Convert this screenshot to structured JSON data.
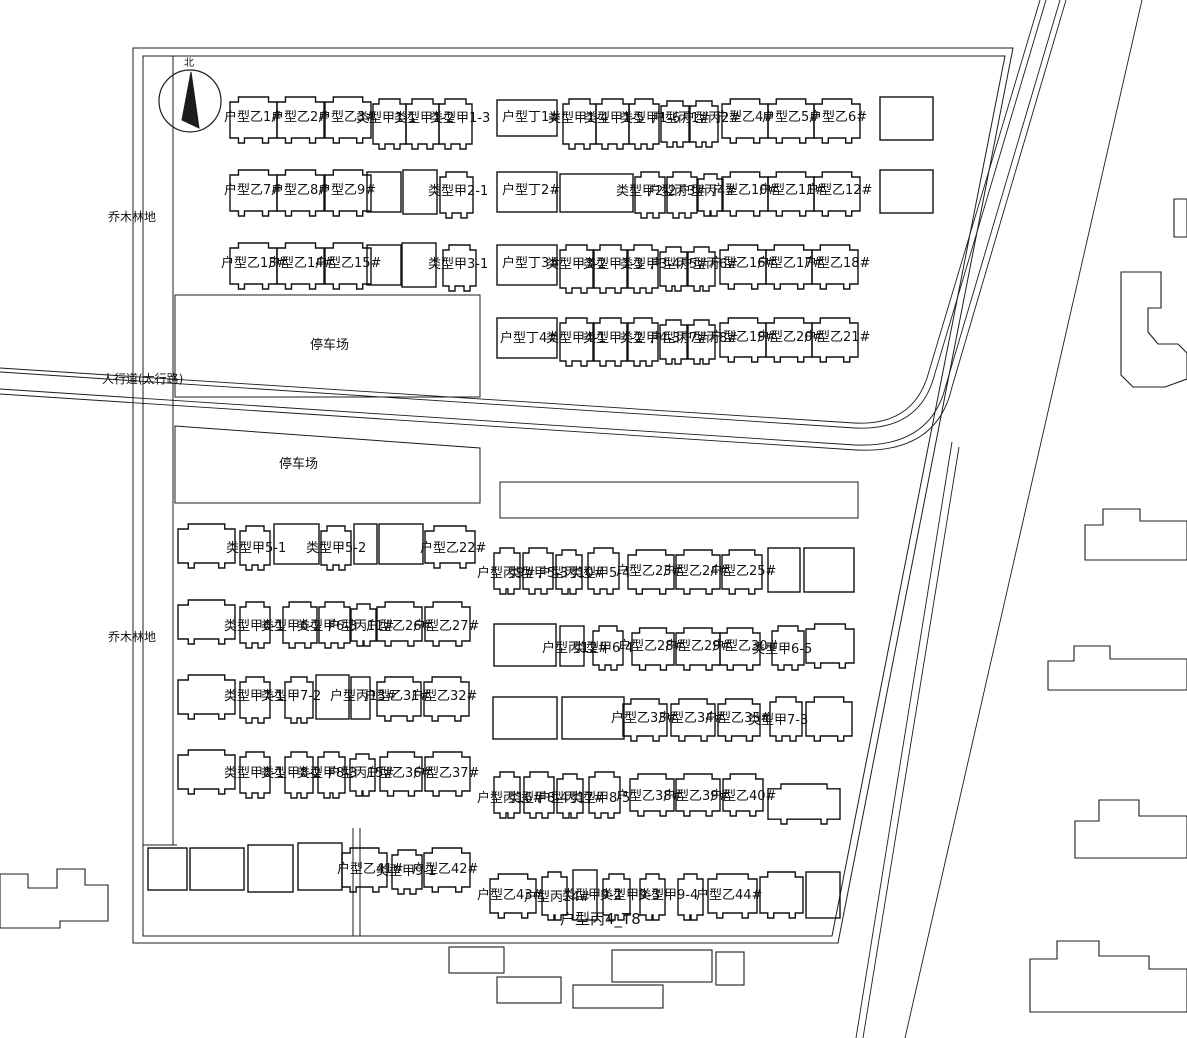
{
  "meta": {
    "width": 1187,
    "height": 1038
  },
  "colors": {
    "bg": "#ffffff",
    "line": "#1c1c1c",
    "building": "#111111",
    "text": "#111111"
  },
  "drawing": {
    "boundary": [
      "M133,48 L1013,48 L838,943 L133,943 Z",
      "M143,56 L1005,56 L832,936 L143,936 Z"
    ],
    "aux_lines": [
      "M173,56 L173,845",
      "M143,845 L177,845",
      "M353,828 L353,936",
      "M360,828 L360,936"
    ],
    "roads": [
      "M1040,0 L927,378 Q911,426 854,423 L0,368",
      "M1046,0 L933,380 Q917,431 855,428 L0,372",
      "M1060,0 L946,385 Q931,448 855,445 L0,389",
      "M1066,0 L952,387 Q937,454 856,450 L0,394",
      "M1142,0 L905,1038",
      "M952,442 L856,1038",
      "M959,447 L863,1038"
    ],
    "parking_areas": [
      "175,295 480,295 480,397 175,397",
      "175,426 480,448 480,503 175,503",
      "500,482 858,482 858,518 500,518"
    ],
    "outside_buildings": [
      "0,874 28,874 28,888 57,888 57,869 85,869 85,885 108,885 108,921 60,921 60,928 0,928",
      "1174,199 1187,199 1187,237 1174,237",
      "1121,272 1161,272 1161,308 1148,308 1148,332 1158,344 1178,344 1187,353 1187,379 1165,387 1133,387 1121,375",
      "1085,525 1103,525 1103,509 1140,509 1140,521 1187,521 1187,560 1085,560",
      "1048,661 1074,661 1074,646 1110,646 1110,659 1187,659 1187,690 1048,690",
      "1075,821 1099,821 1099,800 1139,800 1139,816 1187,816 1187,858 1075,858",
      "1030,959 1057,959 1057,941 1099,941 1099,956 1149,956 1149,969 1187,969 1187,1012 1030,1012"
    ],
    "neighbor_rects": [
      [
        449,
        947,
        55,
        26
      ],
      [
        497,
        977,
        64,
        26
      ],
      [
        612,
        950,
        100,
        32
      ],
      [
        573,
        985,
        90,
        23
      ],
      [
        716,
        952,
        28,
        33
      ]
    ],
    "buildings": [
      [
        230,
        97,
        47,
        46,
        "n"
      ],
      [
        277,
        97,
        47,
        46,
        "n"
      ],
      [
        325,
        97,
        46,
        46,
        "n"
      ],
      [
        373,
        99,
        33,
        50,
        "n"
      ],
      [
        406,
        99,
        33,
        50,
        "n"
      ],
      [
        439,
        99,
        33,
        50,
        "n"
      ],
      [
        497,
        100,
        60,
        36,
        "r"
      ],
      [
        563,
        99,
        33,
        50,
        "n"
      ],
      [
        596,
        99,
        33,
        50,
        "n"
      ],
      [
        629,
        99,
        30,
        50,
        "n"
      ],
      [
        661,
        101,
        28,
        46,
        "n"
      ],
      [
        690,
        101,
        28,
        46,
        "n"
      ],
      [
        722,
        99,
        46,
        44,
        "n"
      ],
      [
        768,
        99,
        46,
        44,
        "n"
      ],
      [
        814,
        99,
        46,
        44,
        "n"
      ],
      [
        880,
        97,
        53,
        43,
        "r"
      ],
      [
        230,
        170,
        47,
        46,
        "n"
      ],
      [
        277,
        170,
        47,
        46,
        "n"
      ],
      [
        325,
        170,
        46,
        46,
        "n"
      ],
      [
        367,
        172,
        34,
        40,
        "r"
      ],
      [
        403,
        170,
        34,
        44,
        "r"
      ],
      [
        440,
        172,
        33,
        46,
        "n"
      ],
      [
        497,
        172,
        60,
        40,
        "r"
      ],
      [
        560,
        174,
        73,
        38,
        "r"
      ],
      [
        635,
        172,
        30,
        46,
        "n"
      ],
      [
        667,
        172,
        30,
        46,
        "n"
      ],
      [
        698,
        174,
        25,
        42,
        "n"
      ],
      [
        722,
        172,
        46,
        44,
        "n"
      ],
      [
        768,
        172,
        46,
        44,
        "n"
      ],
      [
        814,
        172,
        46,
        44,
        "n"
      ],
      [
        880,
        170,
        53,
        43,
        "r"
      ],
      [
        230,
        243,
        47,
        46,
        "n"
      ],
      [
        277,
        243,
        47,
        46,
        "n"
      ],
      [
        325,
        243,
        46,
        46,
        "n"
      ],
      [
        367,
        245,
        34,
        40,
        "r"
      ],
      [
        402,
        243,
        34,
        44,
        "r"
      ],
      [
        443,
        245,
        33,
        46,
        "n"
      ],
      [
        497,
        245,
        60,
        40,
        "r"
      ],
      [
        560,
        245,
        33,
        48,
        "n"
      ],
      [
        594,
        245,
        33,
        48,
        "n"
      ],
      [
        628,
        245,
        30,
        48,
        "n"
      ],
      [
        660,
        247,
        27,
        44,
        "n"
      ],
      [
        688,
        247,
        27,
        44,
        "n"
      ],
      [
        720,
        245,
        46,
        44,
        "n"
      ],
      [
        766,
        245,
        46,
        44,
        "n"
      ],
      [
        812,
        245,
        46,
        44,
        "n"
      ],
      [
        497,
        318,
        60,
        40,
        "r"
      ],
      [
        560,
        318,
        33,
        48,
        "n"
      ],
      [
        594,
        318,
        33,
        48,
        "n"
      ],
      [
        628,
        318,
        30,
        48,
        "n"
      ],
      [
        660,
        320,
        27,
        44,
        "n"
      ],
      [
        688,
        320,
        27,
        44,
        "n"
      ],
      [
        720,
        318,
        46,
        44,
        "n"
      ],
      [
        766,
        318,
        46,
        44,
        "n"
      ],
      [
        812,
        318,
        46,
        44,
        "n"
      ],
      [
        178,
        524,
        57,
        44,
        "n"
      ],
      [
        240,
        526,
        30,
        44,
        "n"
      ],
      [
        274,
        524,
        45,
        40,
        "r"
      ],
      [
        321,
        526,
        30,
        44,
        "n"
      ],
      [
        354,
        524,
        23,
        40,
        "r"
      ],
      [
        379,
        524,
        44,
        40,
        "r"
      ],
      [
        425,
        526,
        50,
        42,
        "n"
      ],
      [
        494,
        548,
        26,
        46,
        "n"
      ],
      [
        523,
        548,
        30,
        46,
        "n"
      ],
      [
        556,
        550,
        26,
        44,
        "n"
      ],
      [
        588,
        548,
        31,
        46,
        "n"
      ],
      [
        628,
        550,
        46,
        44,
        "n"
      ],
      [
        676,
        550,
        44,
        44,
        "n"
      ],
      [
        722,
        550,
        40,
        44,
        "n"
      ],
      [
        768,
        548,
        32,
        44,
        "r"
      ],
      [
        804,
        548,
        50,
        44,
        "r"
      ],
      [
        178,
        600,
        57,
        44,
        "n"
      ],
      [
        240,
        602,
        30,
        46,
        "n"
      ],
      [
        283,
        602,
        34,
        46,
        "n"
      ],
      [
        319,
        602,
        31,
        46,
        "n"
      ],
      [
        351,
        604,
        25,
        42,
        "n"
      ],
      [
        377,
        602,
        45,
        44,
        "n"
      ],
      [
        425,
        602,
        45,
        44,
        "n"
      ],
      [
        494,
        624,
        62,
        42,
        "r"
      ],
      [
        560,
        626,
        24,
        40,
        "r"
      ],
      [
        593,
        626,
        30,
        44,
        "n"
      ],
      [
        632,
        628,
        42,
        42,
        "n"
      ],
      [
        676,
        628,
        44,
        42,
        "n"
      ],
      [
        720,
        628,
        40,
        42,
        "n"
      ],
      [
        772,
        626,
        32,
        44,
        "n"
      ],
      [
        806,
        624,
        48,
        44,
        "n"
      ],
      [
        178,
        675,
        57,
        44,
        "n"
      ],
      [
        240,
        677,
        30,
        46,
        "n"
      ],
      [
        285,
        677,
        28,
        46,
        "n"
      ],
      [
        316,
        675,
        33,
        44,
        "r"
      ],
      [
        351,
        677,
        19,
        42,
        "r"
      ],
      [
        377,
        677,
        44,
        44,
        "n"
      ],
      [
        424,
        677,
        45,
        44,
        "n"
      ],
      [
        493,
        697,
        64,
        42,
        "r"
      ],
      [
        562,
        697,
        62,
        42,
        "r"
      ],
      [
        623,
        699,
        44,
        42,
        "n"
      ],
      [
        671,
        699,
        44,
        42,
        "n"
      ],
      [
        718,
        699,
        42,
        42,
        "n"
      ],
      [
        770,
        697,
        32,
        44,
        "n"
      ],
      [
        806,
        697,
        46,
        44,
        "n"
      ],
      [
        178,
        750,
        57,
        44,
        "n"
      ],
      [
        240,
        752,
        30,
        46,
        "n"
      ],
      [
        285,
        752,
        28,
        46,
        "n"
      ],
      [
        318,
        752,
        27,
        46,
        "n"
      ],
      [
        350,
        754,
        25,
        42,
        "n"
      ],
      [
        380,
        752,
        42,
        44,
        "n"
      ],
      [
        425,
        752,
        45,
        44,
        "n"
      ],
      [
        494,
        772,
        26,
        46,
        "n"
      ],
      [
        524,
        772,
        30,
        46,
        "n"
      ],
      [
        557,
        774,
        26,
        44,
        "n"
      ],
      [
        589,
        772,
        31,
        46,
        "n"
      ],
      [
        630,
        774,
        44,
        42,
        "n"
      ],
      [
        676,
        774,
        44,
        42,
        "n"
      ],
      [
        723,
        774,
        40,
        42,
        "n"
      ],
      [
        768,
        784,
        72,
        40,
        "n"
      ],
      [
        148,
        848,
        39,
        42,
        "r"
      ],
      [
        190,
        848,
        54,
        42,
        "r"
      ],
      [
        248,
        845,
        45,
        47,
        "r"
      ],
      [
        298,
        843,
        44,
        47,
        "r"
      ],
      [
        342,
        848,
        45,
        44,
        "n"
      ],
      [
        392,
        850,
        30,
        44,
        "n"
      ],
      [
        424,
        848,
        46,
        44,
        "n"
      ],
      [
        490,
        874,
        46,
        44,
        "n"
      ],
      [
        542,
        872,
        25,
        48,
        "n"
      ],
      [
        573,
        870,
        24,
        50,
        "r"
      ],
      [
        603,
        874,
        27,
        46,
        "n"
      ],
      [
        640,
        874,
        25,
        46,
        "n"
      ],
      [
        678,
        874,
        25,
        46,
        "n"
      ],
      [
        708,
        874,
        49,
        44,
        "n"
      ],
      [
        760,
        872,
        43,
        46,
        "n"
      ],
      [
        806,
        872,
        34,
        46,
        "r"
      ]
    ],
    "building_labels": [
      [
        "户型乙1#",
        224,
        121
      ],
      [
        "户型乙2#",
        271,
        121
      ],
      [
        "户型乙3#",
        318,
        121
      ],
      [
        "类型甲1-1",
        356,
        122
      ],
      [
        "类型甲1-2",
        394,
        122
      ],
      [
        "类型甲1-3",
        430,
        122
      ],
      [
        "户型丁1#",
        502,
        121
      ],
      [
        "类型甲1-4",
        548,
        122
      ],
      [
        "类型甲1-5",
        584,
        122
      ],
      [
        "类型甲1-6",
        620,
        122
      ],
      [
        "户型丙1#",
        652,
        122
      ],
      [
        "户型丙2#",
        682,
        122
      ],
      [
        "户型乙4#",
        716,
        121
      ],
      [
        "户型乙5#",
        762,
        121
      ],
      [
        "户型乙6#",
        809,
        121
      ],
      [
        "户型乙7#",
        224,
        194
      ],
      [
        "户型乙8#",
        271,
        194
      ],
      [
        "户型乙9#",
        318,
        194
      ],
      [
        "类型甲2-1",
        428,
        195
      ],
      [
        "户型丁2#",
        502,
        194
      ],
      [
        "类型甲2-2",
        616,
        195
      ],
      [
        "户型丙3#",
        648,
        195
      ],
      [
        "户型丙4#",
        678,
        195
      ],
      [
        "户型乙10#",
        712,
        194
      ],
      [
        "户型乙11#",
        759,
        194
      ],
      [
        "户型乙12#",
        806,
        194
      ],
      [
        "户型乙13#",
        221,
        267
      ],
      [
        "户型乙14#",
        268,
        267
      ],
      [
        "户型乙15#",
        315,
        267
      ],
      [
        "类型甲3-1",
        428,
        268
      ],
      [
        "户型丁3#",
        502,
        267
      ],
      [
        "类型甲3-2",
        546,
        268
      ],
      [
        "类型甲3-3",
        583,
        268
      ],
      [
        "类型甲3-4",
        620,
        268
      ],
      [
        "户型丙5#",
        650,
        268
      ],
      [
        "户型丙6#",
        680,
        268
      ],
      [
        "户型乙16#",
        710,
        267
      ],
      [
        "户型乙17#",
        757,
        267
      ],
      [
        "户型乙18#",
        804,
        267
      ],
      [
        "户型丁4#",
        500,
        342
      ],
      [
        "类型甲4-1",
        546,
        342
      ],
      [
        "类型甲4-2",
        583,
        342
      ],
      [
        "类型甲4-3",
        620,
        342
      ],
      [
        "户型丙7#",
        650,
        342
      ],
      [
        "户型丙8#",
        680,
        342
      ],
      [
        "户型乙19#",
        710,
        341
      ],
      [
        "户型乙20#",
        757,
        341
      ],
      [
        "户型乙21#",
        804,
        341
      ],
      [
        "类型甲5-1",
        226,
        552
      ],
      [
        "类型甲5-2",
        306,
        552
      ],
      [
        "户型乙22#",
        420,
        552
      ],
      [
        "户型丙9#",
        477,
        577
      ],
      [
        "类型甲5-3",
        508,
        577
      ],
      [
        "户型丙10#",
        538,
        577
      ],
      [
        "类型甲5-4",
        570,
        577
      ],
      [
        "户型乙23#",
        616,
        575
      ],
      [
        "户型乙24#",
        663,
        575
      ],
      [
        "户型乙25#",
        710,
        575
      ],
      [
        "类型甲6-1",
        224,
        630
      ],
      [
        "类型甲6-2",
        261,
        630
      ],
      [
        "类型甲6-3",
        297,
        630
      ],
      [
        "户型丙11#",
        328,
        630
      ],
      [
        "户型乙26#",
        366,
        630
      ],
      [
        "户型乙27#",
        413,
        630
      ],
      [
        "户型丙12#",
        542,
        652
      ],
      [
        "类型甲6-4",
        573,
        652
      ],
      [
        "户型乙28#",
        618,
        650
      ],
      [
        "户型乙29#",
        665,
        650
      ],
      [
        "户型乙30#",
        712,
        650
      ],
      [
        "类型甲6-5",
        752,
        653
      ],
      [
        "类型甲7-1",
        224,
        700
      ],
      [
        "类型甲7-2",
        261,
        700
      ],
      [
        "户型丙13#",
        330,
        700
      ],
      [
        "户型乙31#",
        364,
        700
      ],
      [
        "户型乙32#",
        411,
        700
      ],
      [
        "户型乙33#",
        611,
        722
      ],
      [
        "户型乙34#",
        658,
        722
      ],
      [
        "户型乙35#",
        705,
        722
      ],
      [
        "类型甲7-3",
        748,
        724
      ],
      [
        "类型甲8-1",
        224,
        777
      ],
      [
        "类型甲8-2",
        261,
        777
      ],
      [
        "类型甲8-3",
        297,
        777
      ],
      [
        "户型丙15#",
        328,
        777
      ],
      [
        "户型乙36#",
        366,
        777
      ],
      [
        "户型乙37#",
        413,
        777
      ],
      [
        "户型丙16#",
        477,
        802
      ],
      [
        "类型甲8-4",
        508,
        802
      ],
      [
        "户型丙17#",
        538,
        802
      ],
      [
        "类型甲8-5",
        570,
        802
      ],
      [
        "户型乙38#",
        616,
        800
      ],
      [
        "户型乙39#",
        663,
        800
      ],
      [
        "户型乙40#",
        710,
        800
      ],
      [
        "户型乙41#",
        337,
        873
      ],
      [
        "类型甲9-1",
        376,
        875
      ],
      [
        "户型乙42#",
        412,
        873
      ],
      [
        "户型乙43#",
        477,
        899
      ],
      [
        "户型丙14#",
        524,
        901
      ],
      [
        "类型甲9-2",
        562,
        899
      ],
      [
        "类型甲9-3",
        600,
        899
      ],
      [
        "类型甲9-4",
        638,
        899
      ],
      [
        "户型乙44#",
        696,
        899
      ]
    ],
    "site_labels": [
      [
        "乔木林地",
        108,
        221,
        12
      ],
      [
        "乔木林地",
        108,
        641,
        12
      ],
      [
        "人行道(太行路)",
        102,
        383,
        12
      ],
      [
        "停车场",
        310,
        349,
        13
      ],
      [
        "停车场",
        279,
        468,
        13
      ],
      [
        "户型丙4_T8",
        560,
        924,
        15
      ]
    ],
    "compass": {
      "cx": 190,
      "cy": 101,
      "r": 31,
      "needle": "191,72 199,128 182,120",
      "mark": "北"
    }
  }
}
